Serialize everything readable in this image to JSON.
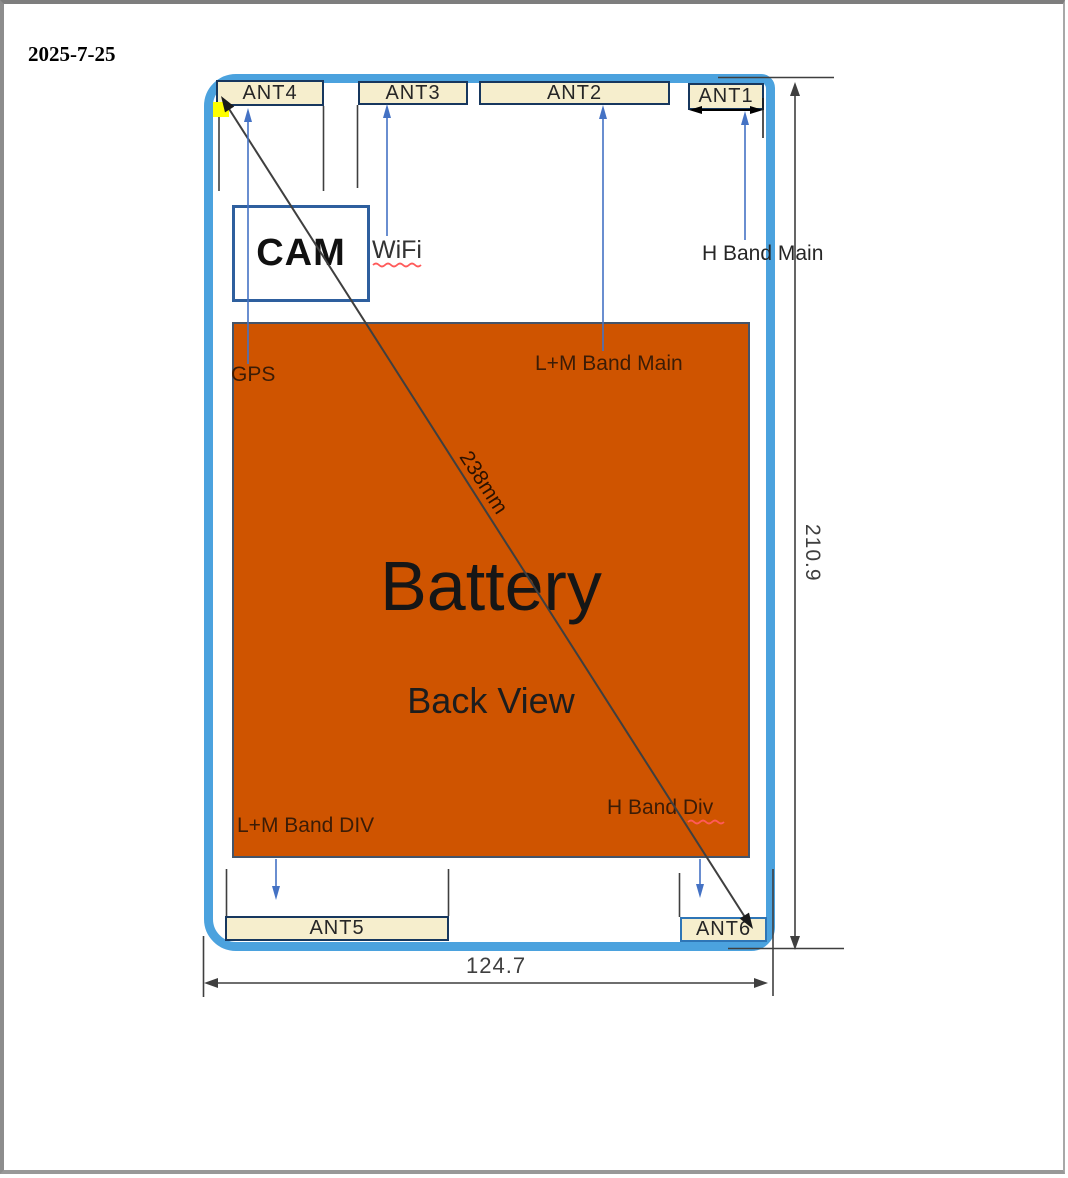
{
  "document": {
    "date": "2025-7-25"
  },
  "diagram": {
    "antennas": {
      "ant1": "ANT1",
      "ant2": "ANT2",
      "ant3": "ANT3",
      "ant4": "ANT4",
      "ant5": "ANT5",
      "ant6": "ANT6"
    },
    "camera": "CAM",
    "battery_label": "Battery",
    "view_label": "Back View",
    "annotations": {
      "gps": "GPS",
      "wifi": "WiFi",
      "h_band_main": "H Band Main",
      "lm_band_main": "L+M Band Main",
      "lm_band_div": "L+M Band DIV",
      "h_band_div": "H Band Div"
    },
    "dimensions": {
      "diagonal": "238mm",
      "height": "210.9",
      "width": "124.7"
    },
    "colors": {
      "device_outline": "#4BA2DE",
      "battery_fill": "#CF5400",
      "antenna_fill": "#F6EECD",
      "antenna_border": "#17375E",
      "camera_border": "#2E5F9E",
      "arrow_blue": "#4472C4",
      "dimension_gray": "#3F3F3F",
      "highlight_yellow": "#FFFF00",
      "underline_red": "#FF5A5A"
    }
  }
}
